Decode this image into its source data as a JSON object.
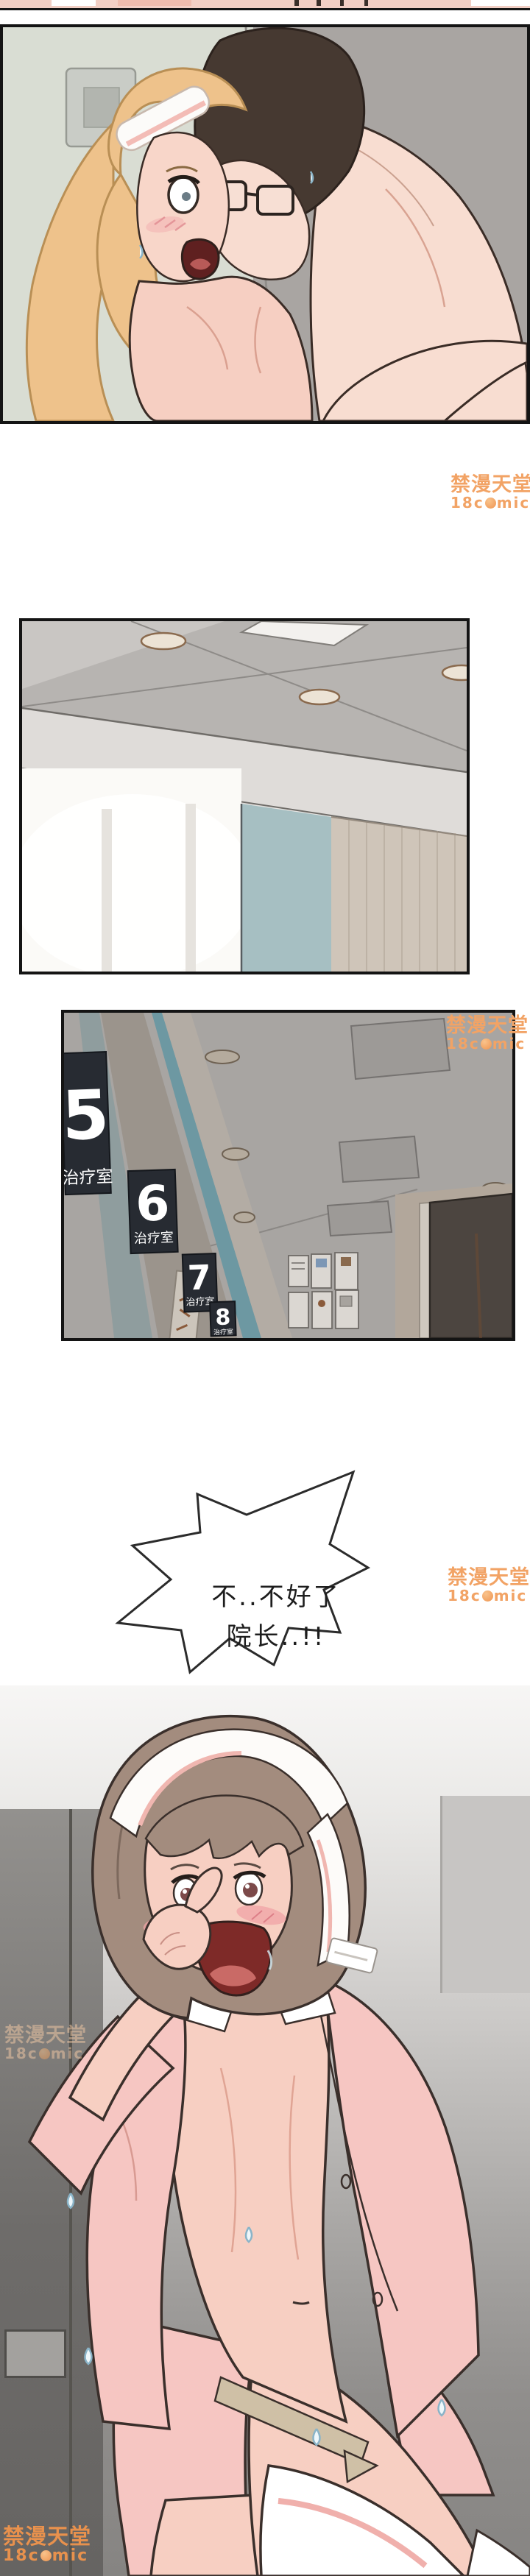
{
  "comic": {
    "speech_bubble": {
      "line1": "不..不好了",
      "line2": "院长..!!"
    },
    "hallway_signs": [
      {
        "number": "5",
        "label": "治疗室"
      },
      {
        "number": "6",
        "label": "治疗室"
      },
      {
        "number": "7",
        "label": "治疗室"
      },
      {
        "number": "8",
        "label": "治疗室"
      }
    ],
    "watermark": {
      "brand": "禁漫天堂",
      "logo_prefix": "18c",
      "logo_suffix": "mic",
      "logo_full": "18comic",
      "color": "#f2a365"
    }
  }
}
